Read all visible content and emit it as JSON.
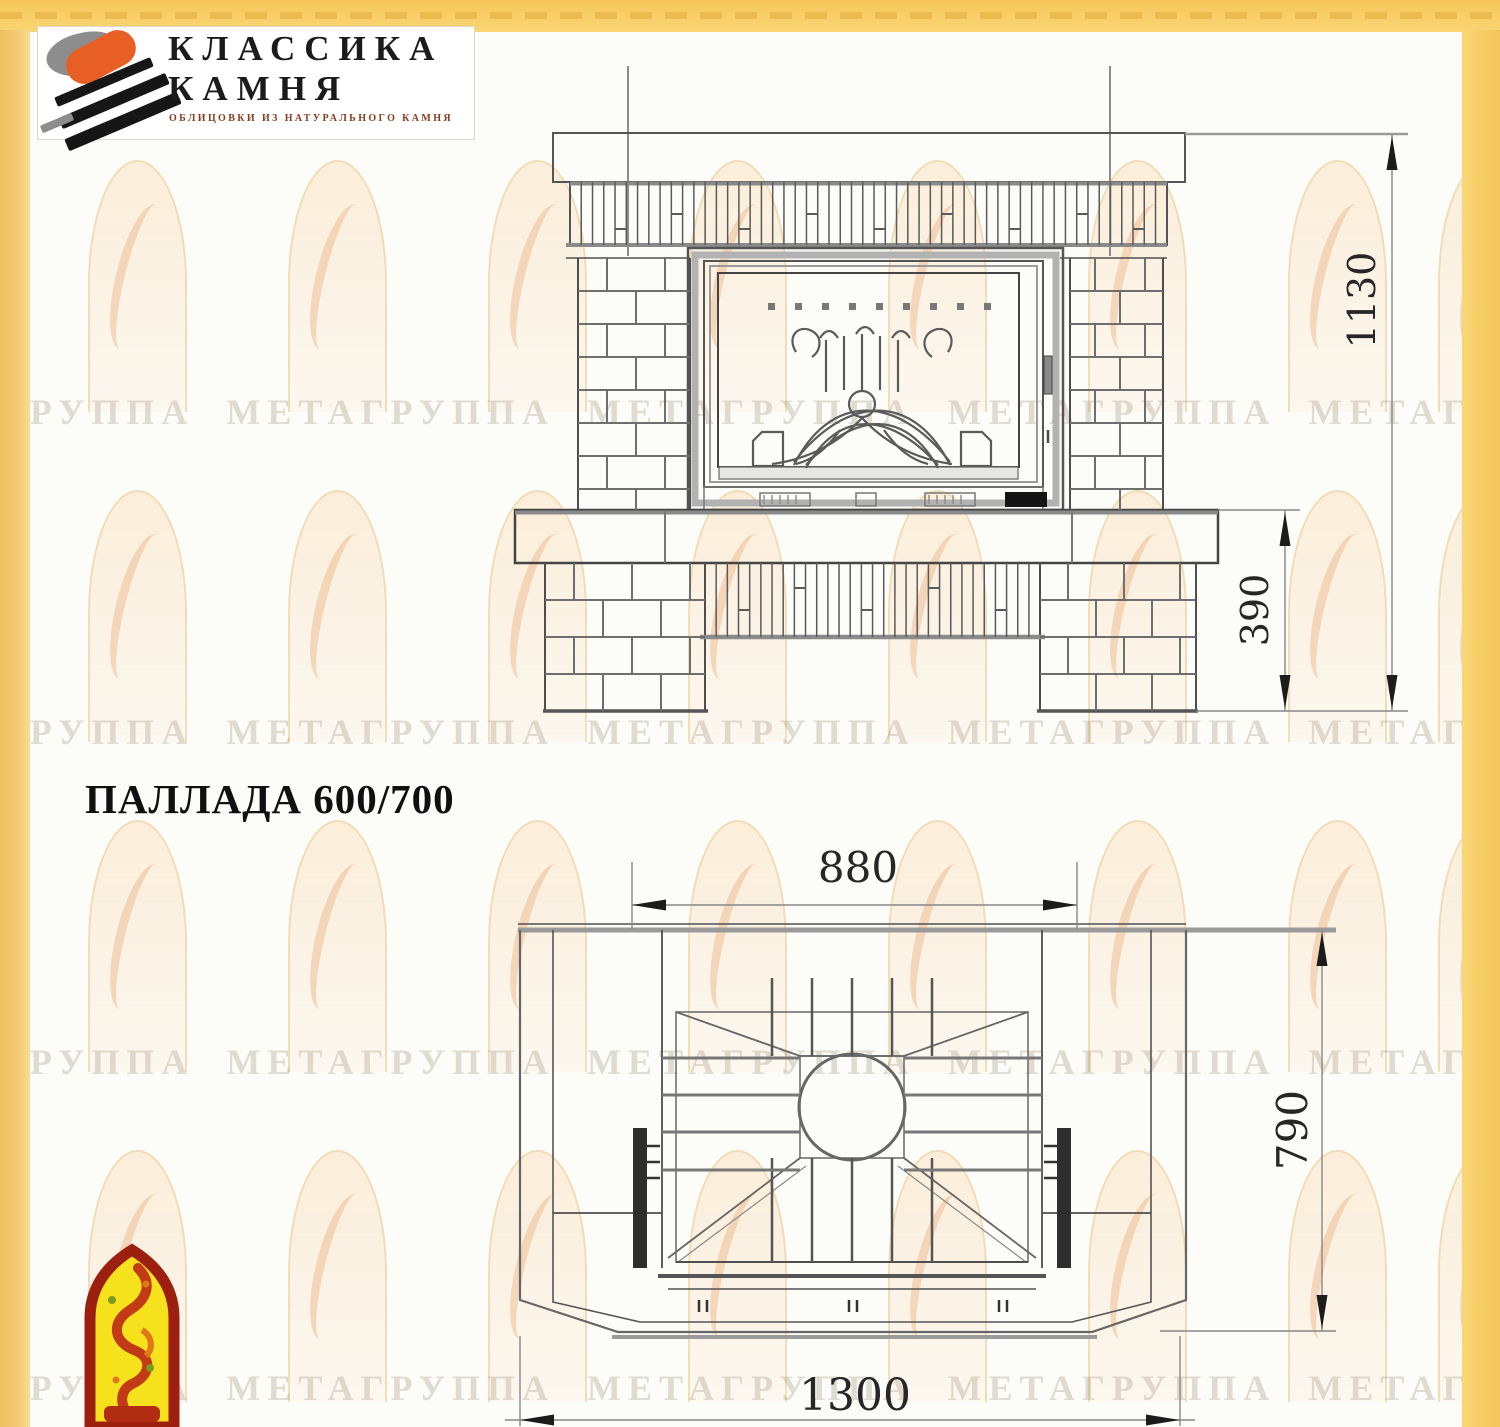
{
  "brand": {
    "name_line1": "КЛАССИКА",
    "name_line2": "КАМНЯ",
    "tagline": "ОБЛИЦОВКИ ИЗ НАТУРАЛЬНОГО КАМНЯ"
  },
  "title": "ПАЛЛАДА 600/700",
  "watermark": {
    "phrase": "ГРУППА МЕТАГРУППА МЕТАГРУППА МЕТАГРУППА МЕТАГРУППА МЕТА"
  },
  "drawings": {
    "front_view": {
      "overall_height_mm": "1130",
      "base_height_mm": "390"
    },
    "plan_view": {
      "firebox_width_mm": "880",
      "depth_mm": "790",
      "overall_width_mm": "1300"
    }
  },
  "colors": {
    "accent_yellow": "#f6cd64",
    "logo_orange": "#e85f26",
    "emblem_red": "#a82312",
    "emblem_yellow": "#f6e11d"
  }
}
